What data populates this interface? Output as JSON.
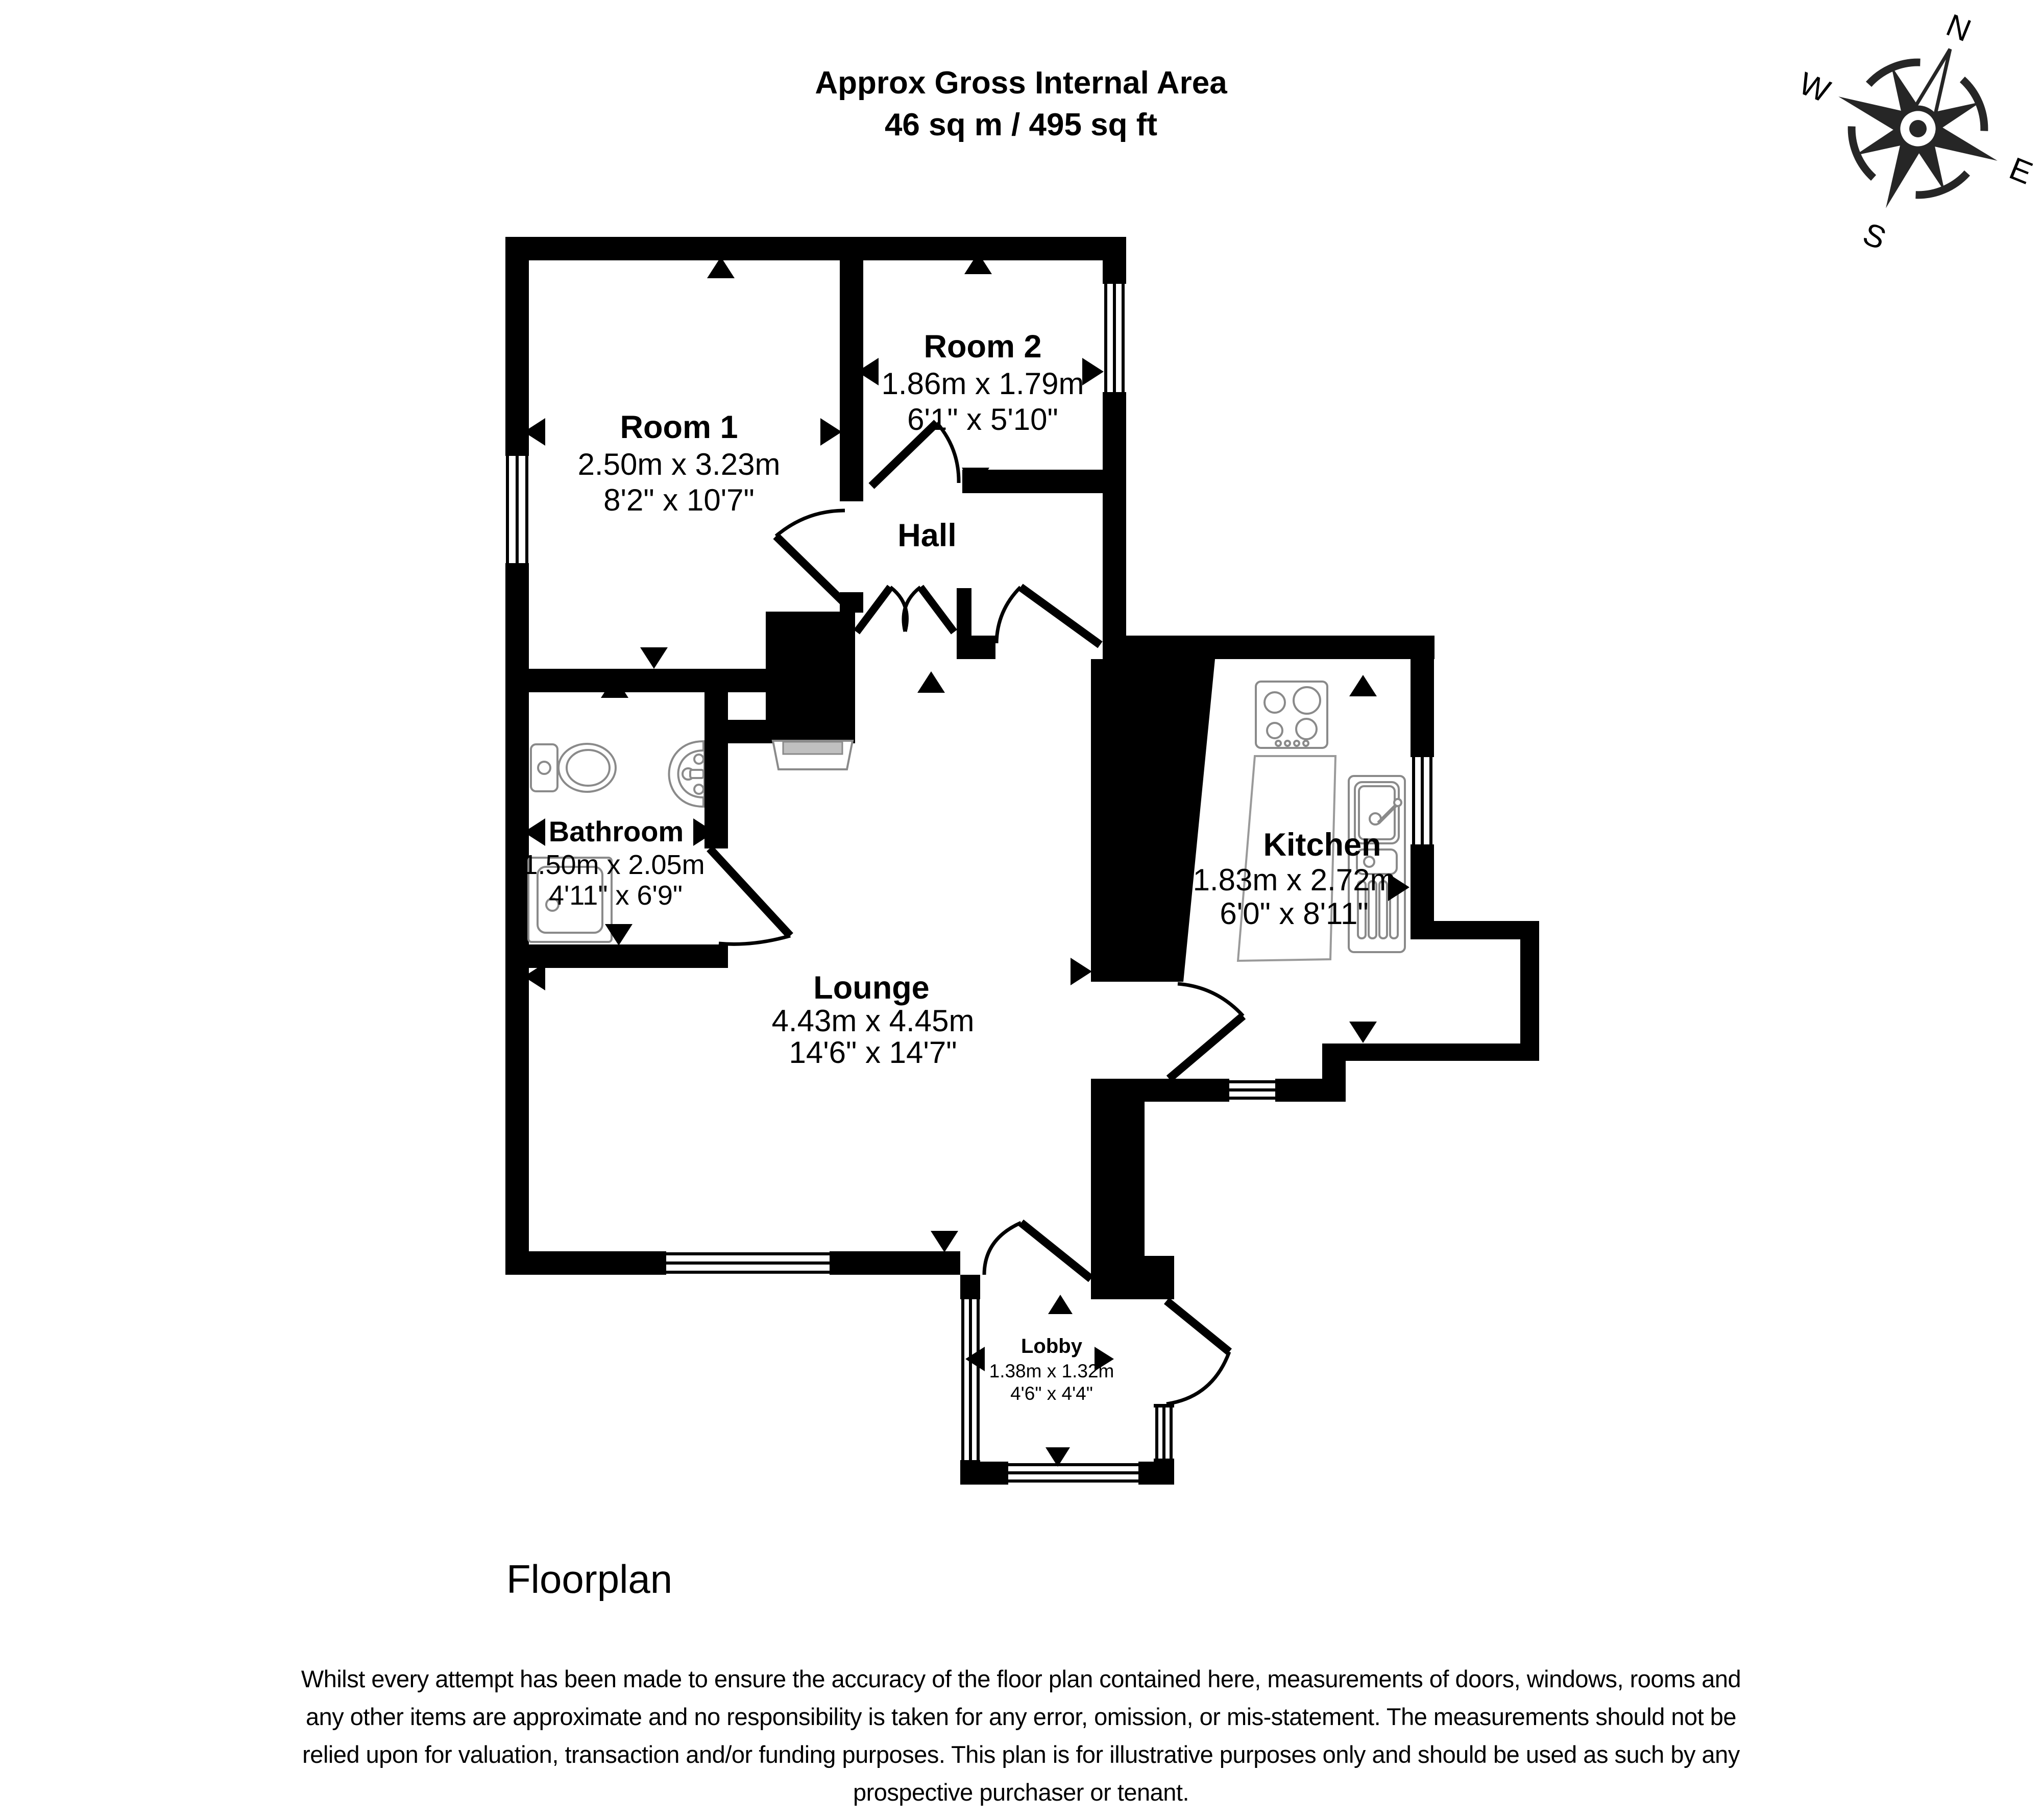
{
  "title": {
    "line1": "Approx Gross Internal Area",
    "line2": "46 sq m / 495 sq ft"
  },
  "compass": {
    "n": "N",
    "e": "E",
    "s": "S",
    "w": "W"
  },
  "rooms": [
    {
      "name": "Room 1",
      "metric": "2.50m x 3.23m",
      "imperial": "8'2\" x 10'7\""
    },
    {
      "name": "Room 2",
      "metric": "1.86m x 1.79m",
      "imperial": "6'1\" x 5'10\""
    },
    {
      "name": "Hall"
    },
    {
      "name": "Bathroom",
      "metric": "1.50m x 2.05m",
      "imperial": "4'11\" x 6'9\""
    },
    {
      "name": "Lounge",
      "metric": "4.43m x 4.45m",
      "imperial": "14'6\" x 14'7\""
    },
    {
      "name": "Kitchen",
      "metric": "1.83m x 2.72m",
      "imperial": "6'0\" x 8'11\""
    },
    {
      "name": "Lobby",
      "metric": "1.38m x 1.32m",
      "imperial": "4'6\" x 4'4\""
    }
  ],
  "footer": {
    "label": "Floorplan",
    "disclaimer_lines": [
      "Whilst every attempt has been made to ensure the accuracy of the floor plan contained here, measurements of doors, windows, rooms and",
      "any other items are approximate and no responsibility is taken for any error, omission, or mis-statement. The measurements should not be",
      "relied upon for valuation, transaction and/or funding purposes. This plan is for illustrative purposes only and should be used as such by any",
      "prospective purchaser or tenant."
    ]
  },
  "colors": {
    "wall": "#000000",
    "compass": "#262626",
    "fixture_outline": "#8a8a8a",
    "fireplace_fill": "#c0c0c0"
  }
}
